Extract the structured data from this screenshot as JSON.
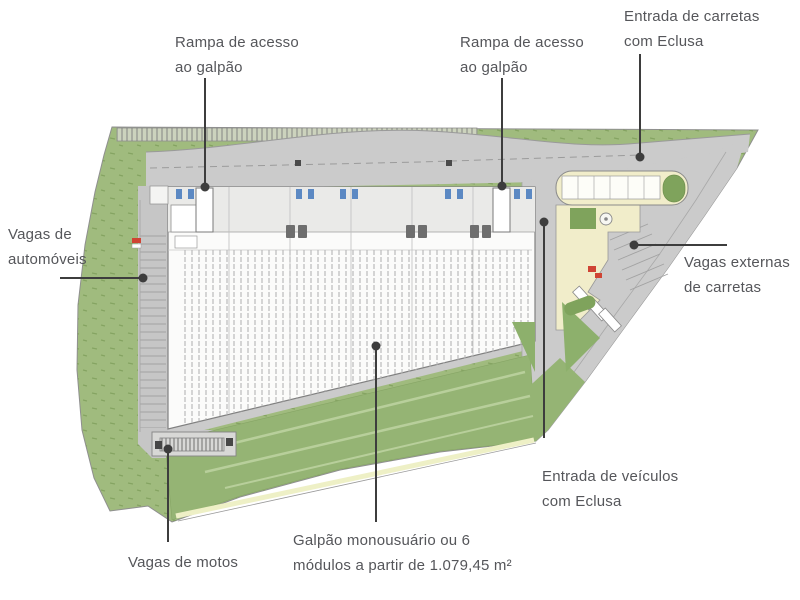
{
  "labels": {
    "rampa_acesso_1": {
      "line1": "Rampa de acesso",
      "line2": "ao galpão"
    },
    "rampa_acesso_2": {
      "line1": "Rampa de acesso",
      "line2": "ao galpão"
    },
    "entrada_carretas": {
      "line1": "Entrada de carretas",
      "line2": "com Eclusa"
    },
    "vagas_automoveis": {
      "line1": "Vagas de",
      "line2": "automóveis"
    },
    "vagas_externas": {
      "line1": "Vagas externas",
      "line2": "de carretas"
    },
    "entrada_veiculos": {
      "line1": "Entrada de veículos",
      "line2": "com Eclusa"
    },
    "vagas_motos": {
      "line1": "Vagas de motos"
    },
    "galpao_modulos": {
      "line1": "Galpão monousuário ou 6",
      "line2": "módulos a partir de 1.079,45 m²"
    }
  },
  "colors": {
    "green_perimeter": "#a0bb7e",
    "green_dark_accent": "#7fa35c",
    "green_slope": "#95b474",
    "slope_stripe_light": "#b8cf9b",
    "stripe_cream": "#eef0c6",
    "pavement_gray": "#cbcbcb",
    "building_white": "#fbfbfa",
    "gatehouse_cream": "#f1edca",
    "dock_door_blue": "#4d7fc0",
    "alert_red": "#cf4434",
    "label_text": "#55565a",
    "leader_line": "#3d3d3d"
  }
}
